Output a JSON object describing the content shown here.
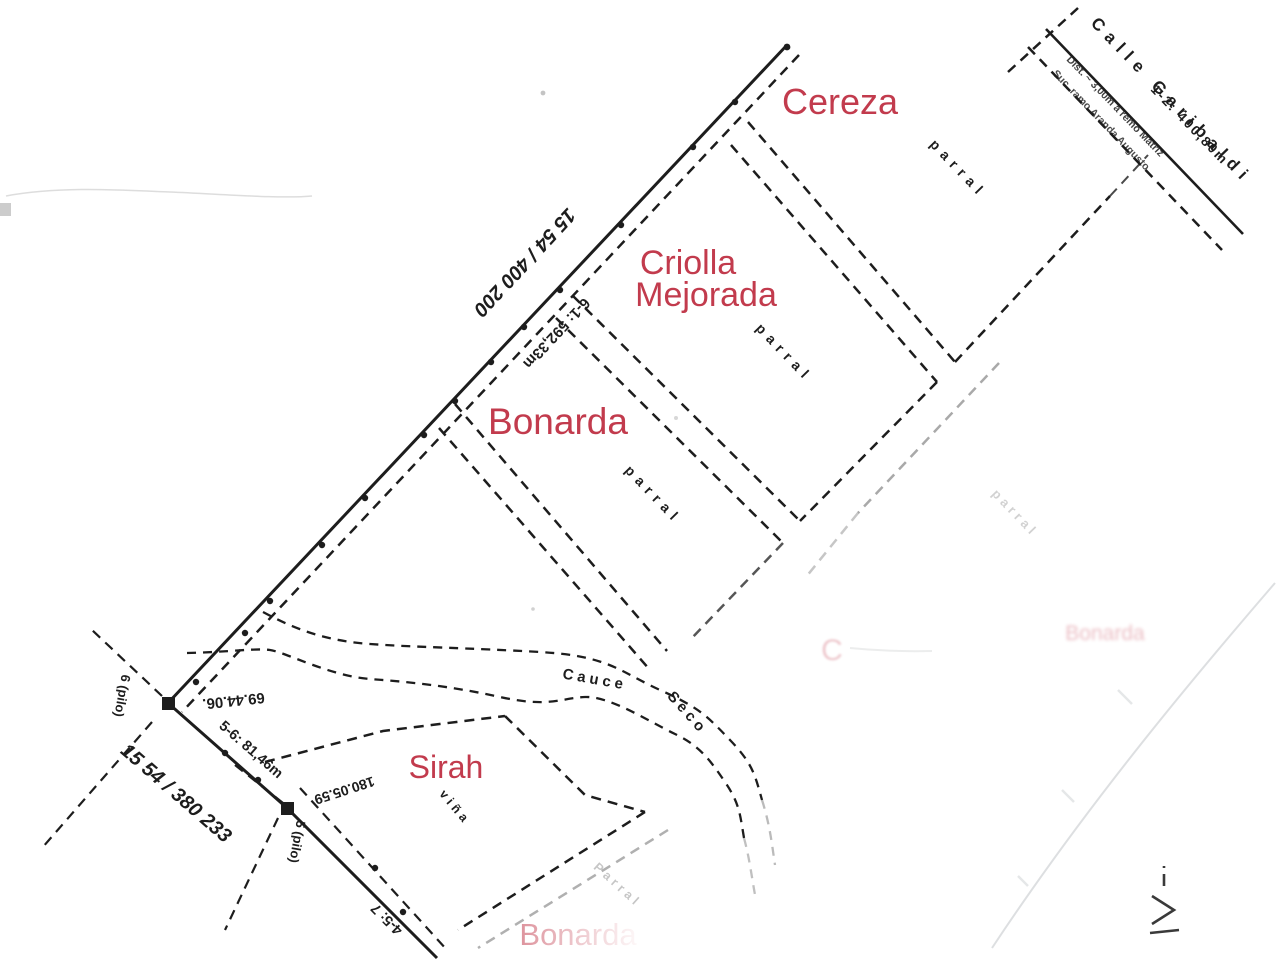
{
  "labels": {
    "street_name": "Calle Garibaldi",
    "street_segment": "1-2: 400,80m",
    "street_note_1": "Dist. ~ 3,00m a remo Matriz",
    "street_note_2": "Suc. ramo Aranda Augusto",
    "boundary_ref_upper": "15 54 / 400 200",
    "boundary_len_upper": "6-1: 592,33m",
    "boundary_ref_lower": "15 54 / 380 233",
    "boundary_len_lower": "5-6: 81,46m",
    "boundary_len_bottom": "4-5: 7",
    "angle_node_6": "69.44.06.",
    "angle_node_5": "180.05.59",
    "node_6_label": "6 (pilo)",
    "node_5_label": "5 (pilo)",
    "channel_word_1": "Cauce",
    "channel_word_2": "Seco"
  },
  "parcels": [
    {
      "name": "Cereza",
      "crop": "parral"
    },
    {
      "name": "Criolla",
      "name_line2": "Mejorada",
      "crop": "parral"
    },
    {
      "name": "Bonarda",
      "crop": "parral"
    },
    {
      "name": "Sirah",
      "crop": "viña"
    },
    {
      "name": "Bonarda",
      "crop": "Parral"
    },
    {
      "crop": "parral"
    }
  ],
  "bleed": {
    "letter": "C",
    "word": "Bonarda"
  },
  "colors": {
    "parcel_label_red": "#c23b4d",
    "ink": "#1d1d1d",
    "faded_ink": "#9aa0a3"
  }
}
